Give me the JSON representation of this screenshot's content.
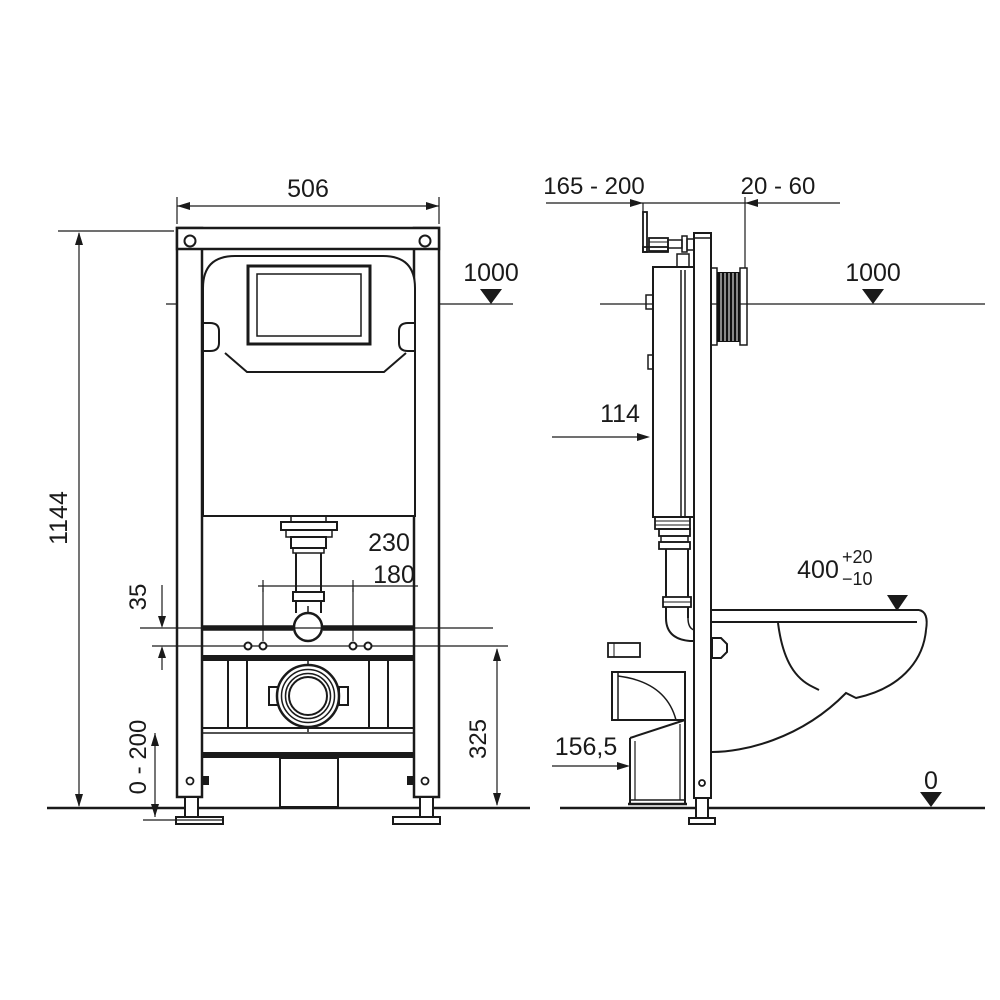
{
  "drawing": {
    "background": "#ffffff",
    "line_color": "#1a1a1a",
    "front": {
      "width": "506",
      "total_height": "1144",
      "level_top": "1000",
      "anchor_spacing_outer": "230",
      "anchor_spacing_inner": "180",
      "rail_offset": "35",
      "leg_adjust_range": "0 - 200",
      "outlet_line_height": "325"
    },
    "side": {
      "bracket_range": "165 - 200",
      "wall_thickness_range": "20 - 60",
      "level_top": "1000",
      "cistern_depth": "114",
      "bowl_height": "400",
      "bowl_tol_plus": "+20",
      "bowl_tol_minus": "−10",
      "outlet_height": "156,5",
      "level_zero": "0"
    }
  }
}
